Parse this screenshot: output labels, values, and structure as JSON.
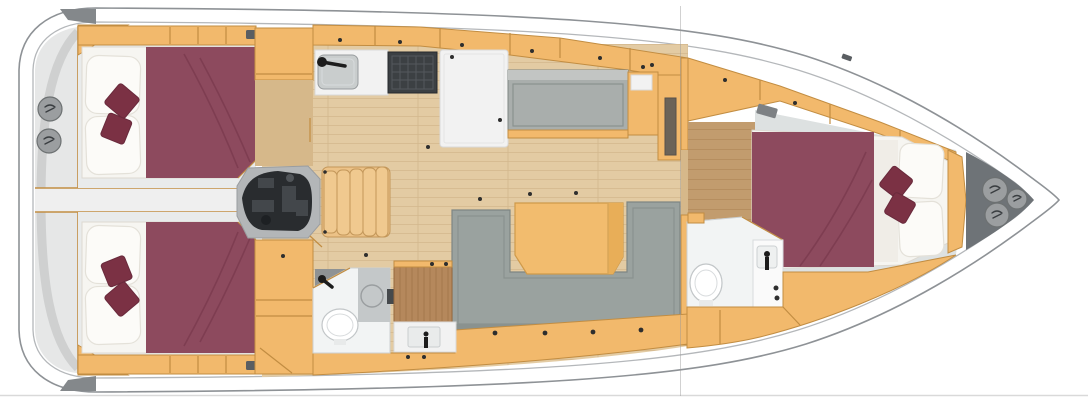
{
  "colors": {
    "hull_fill": "#ffffff",
    "hull_line": "#8e9296",
    "inner_line": "#b4b7ba",
    "deck": "#e6e7e7",
    "deck_band": "#cfd0d0",
    "walkway": "#efefef",
    "corner_wedge": "#84888b",
    "hatch_circle": "#9b9ea0",
    "hatch_ring": "#6d7172",
    "hatch_glyph": "#3a3e41",
    "cabinet": "#f2b96c",
    "cabinet_edge": "#c28d42",
    "cabinet_dark": "#e5ab59",
    "floor": "#e3cba3",
    "floor_line": "#d3b78c",
    "floor_dark": "#c29c6e",
    "floor_dark_line": "#b28a5a",
    "vestibule": "#d6b88a",
    "cabin_floor": "#e9ebeb",
    "linen": "#f6f5f1",
    "linen_edge": "#ddd9d1",
    "pillow": "#fcfbf8",
    "pillow_edge": "#e4e1d9",
    "bed": "#8d4a5e",
    "bed_fold": "#7a3a4e",
    "bed_accent": "#7b3144",
    "bed_accent_edge": "#692a3c",
    "sofa": "#9aa29f",
    "sofa_edge": "#7e8683",
    "sofa_line": "#8a928f",
    "settee": "#a9aeac",
    "settee_top": "#c2c5c3",
    "table": "#f2bc6e",
    "table_edge": "#cf9a4a",
    "table_fold": "#e8ae58",
    "stove": "#3c4043",
    "stove_edge": "#26292c",
    "stove_grid": "#54585c",
    "sink_steel": "#c9cdcd",
    "steel_edge": "#989c9e",
    "counter": "#f2f2f2",
    "counter_edge": "#d9d9d9",
    "bath_floor": "#f2f4f4",
    "bath_edge": "#ccd0d2",
    "shower": "#c4c8c9",
    "shower_ring": "#9a9ea0",
    "porcelain": "#ffffff",
    "porcelain_edge": "#c2c6c8",
    "wood_panel": "#b5885c",
    "wood_panel_line": "#a1744a",
    "wood_panel_edge": "#96683c",
    "engine_bay": "#b3b6b8",
    "engine": "#292c2f",
    "engine_detail": "#43474b",
    "stairs": "#ecc287",
    "stairs_edge": "#c3975a",
    "stair_tread": "#f0c98f",
    "bow_locker": "#6e7377",
    "fixture_black": "#1c1c1c",
    "handle": "#2e2e2e",
    "platform": "#dde1e1",
    "section_line": "#9a9a9a"
  }
}
